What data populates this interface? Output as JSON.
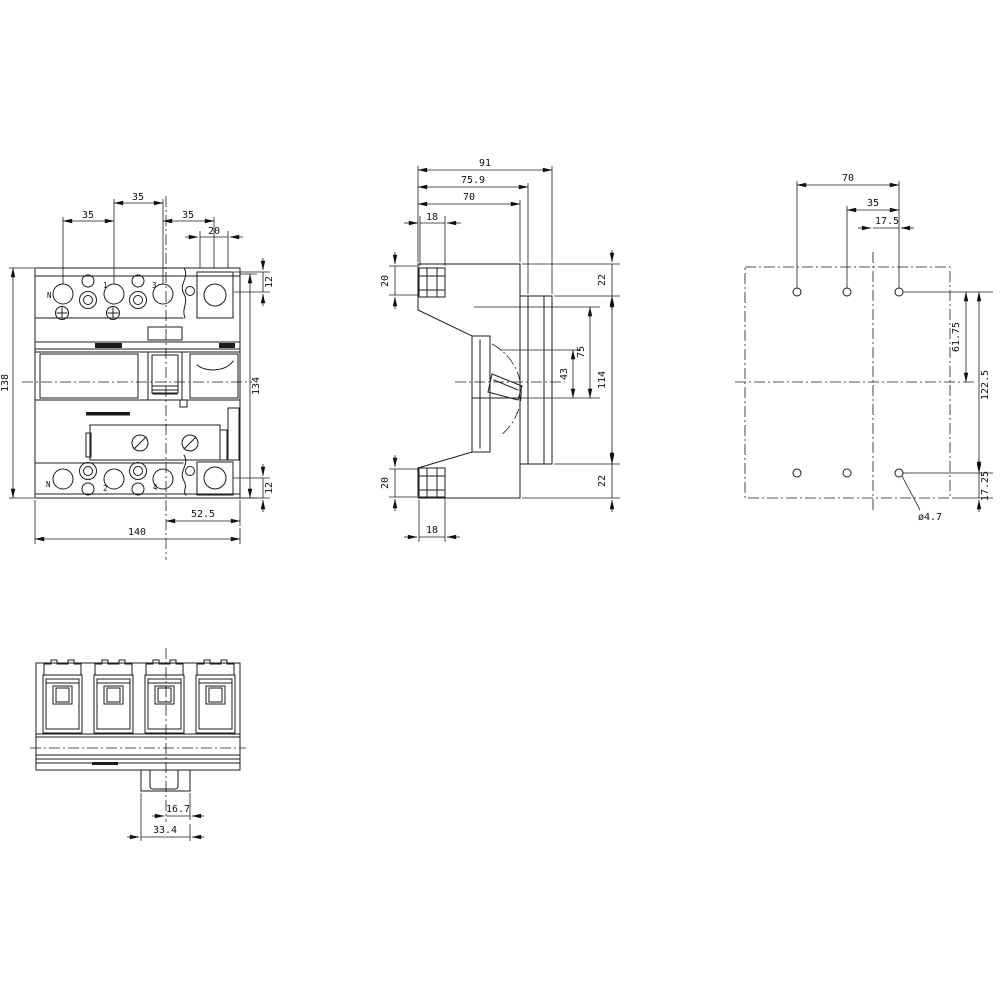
{
  "drawing_type": "technical-dimension-drawing",
  "front": {
    "label_n_top": "N",
    "label_1": "1",
    "label_3": "3",
    "label_n_bot": "N",
    "label_2": "2",
    "label_4": "4",
    "dim_pitch_a": "35",
    "dim_pitch_b": "35",
    "dim_pitch_c": "35",
    "dim_aux": "20",
    "dim_top_right": "12",
    "dim_height_left": "138",
    "dim_height_right": "134",
    "dim_bot_right": "12",
    "dim_offset": "52.5",
    "dim_width": "140"
  },
  "side": {
    "dim_depth_total": "91",
    "dim_depth_front": "75.9",
    "dim_depth_body": "70",
    "dim_foot_top_w": "18",
    "dim_foot_top_h": "20",
    "dim_top_rear": "22",
    "dim_mid_a": "75",
    "dim_mid_b": "43",
    "dim_mid_total": "114",
    "dim_bot_rear": "22",
    "dim_foot_bot_h": "20",
    "dim_foot_bot_w": "18"
  },
  "rear": {
    "dim_hole_pitch": "70",
    "dim_hole_half": "35",
    "dim_hole_offset": "17.5",
    "dim_upper": "61.75",
    "dim_total": "122.5",
    "dim_lower": "17.25",
    "hole_dia_label": "ø4.7"
  },
  "bottom": {
    "dim_half": "16.7",
    "dim_slot": "33.4"
  },
  "colors": {
    "line": "#1b1b1b",
    "background": "#ffffff"
  }
}
